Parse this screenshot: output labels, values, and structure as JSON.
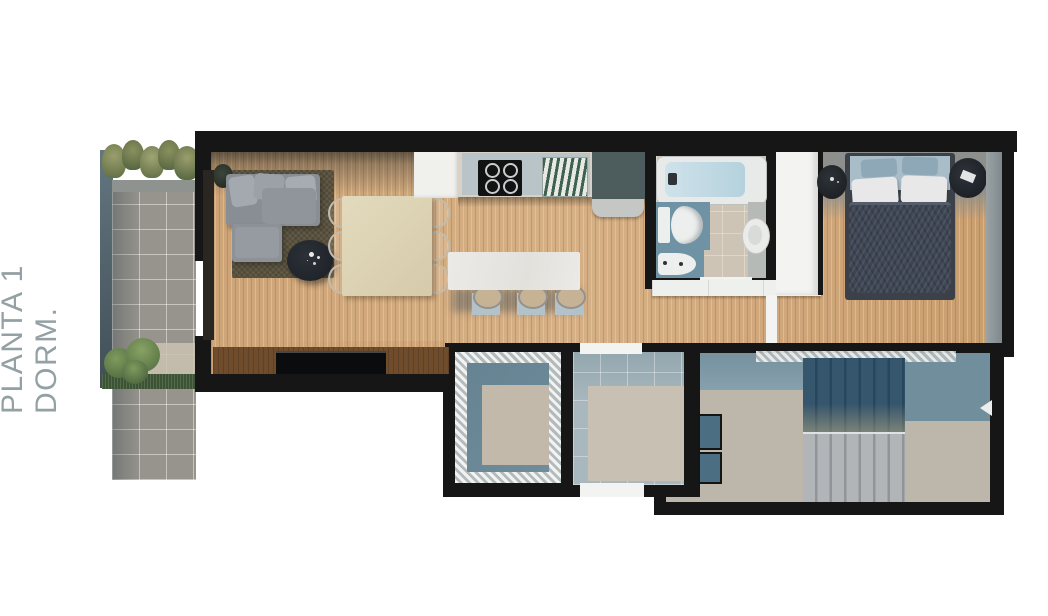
{
  "page": {
    "title": "PLANTA 1 DORM.",
    "title_color": "#94a1a4",
    "background": "#ffffff"
  },
  "palette": {
    "wall_black": "#161616",
    "wood_floor": "#cfa577",
    "patio_tile_gray": "#97948e",
    "patio_plant_green": "#5d7a46",
    "sofa_gray": "#898e94",
    "rug_brown": "#5a523e",
    "dining_table_beige": "#dbd2b4",
    "island_white": "#e9e8e4",
    "stool_mat_blue": "#b3c2c9",
    "counter_gray": "#d9d0c6",
    "stove_black": "#121212",
    "cabinet_teal": "#4d5c5c",
    "tub_water_blue": "#bed7e1",
    "bath_mat_teal": "#6f93a4",
    "wardrobe_white": "#f3f3f1",
    "bed_duvet_navy": "#3e4654",
    "bed_pillow_blue": "#8fa8b8",
    "lower_wall_teal": "#7d98a6",
    "lower_floor_beige": "#bdb6ab",
    "stair_dark_blue": "#27475d",
    "stair_tread_gray": "#b2b5b7"
  }
}
